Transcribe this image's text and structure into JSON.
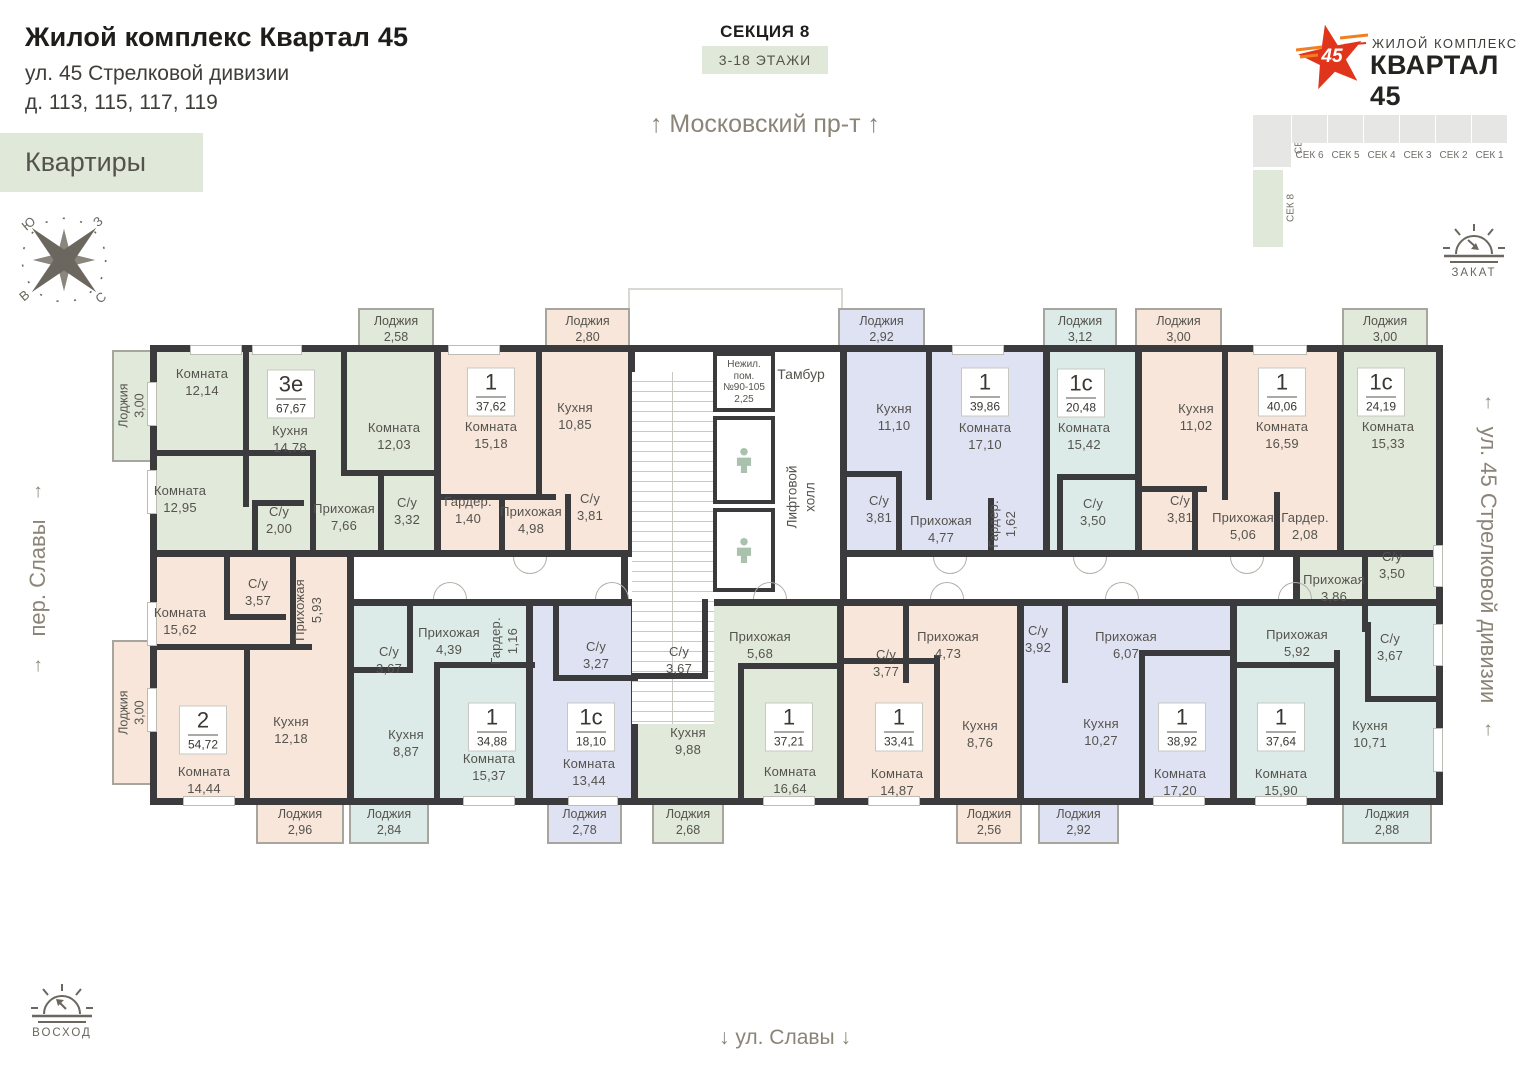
{
  "header": {
    "title": "Жилой комплекс Квартал 45",
    "address_line1": "ул. 45 Стрелковой дивизии",
    "address_line2": "д. 113, 115, 117, 119",
    "apartments_badge": "Квартиры"
  },
  "section": {
    "name": "СЕКЦИЯ 8",
    "floors": "3-18 ЭТАЖИ"
  },
  "streets": {
    "top": "Московский пр-т",
    "bottom": "ул. Славы",
    "left": "пер. Славы",
    "right": "ул. 45 Стрелковой дивизии",
    "arrow_up": "↑",
    "arrow_down": "↓"
  },
  "logo": {
    "number": "45",
    "line1": "ЖИЛОЙ КОМПЛЕКС",
    "line2": "КВАРТАЛ 45"
  },
  "minimap": {
    "top_sections": [
      "СЕК 6",
      "СЕК 5",
      "СЕК 4",
      "СЕК 3",
      "СЕК 2",
      "СЕК 1"
    ],
    "corner_section": "СЕК 7",
    "current_section": "СЕК 8"
  },
  "sun": {
    "sunset": "ЗАКАТ",
    "sunrise": "ВОСХОД"
  },
  "compass": {
    "nw": "Ю",
    "ne": "З",
    "sw": "В",
    "se": "С"
  },
  "core": {
    "nonres": [
      "Нежил.",
      "пом.",
      "№90-105",
      "2,25"
    ],
    "tambour": "Тамбур",
    "lift_hall_1": "Лифтовой",
    "lift_hall_2": "холл"
  },
  "colors": {
    "wall": "#3b3b3d",
    "green": "#e1e9da",
    "beige": "#f7e6d9",
    "lavender": "#dfe2f3",
    "cyan": "#dcebe7",
    "badge_bg": "#dfe8d9",
    "accent_red": "#e0351b",
    "accent_orange": "#f07f1f"
  },
  "plan": {
    "apartments": [
      {
        "id": "3e",
        "type": "3е",
        "area": "67,67",
        "color": "green",
        "rect": [
          150,
          345,
          291,
          212
        ],
        "badge": [
          291,
          394
        ],
        "rooms": [
          {
            "n": "Комната",
            "a": "12,14",
            "x": 202,
            "y": 383
          },
          {
            "n": "Кухня",
            "a": "14,78",
            "x": 290,
            "y": 440
          },
          {
            "n": "Комната",
            "a": "12,03",
            "x": 394,
            "y": 437
          },
          {
            "n": "Комната",
            "a": "12,95",
            "x": 180,
            "y": 500
          },
          {
            "n": "С/у",
            "a": "2,00",
            "x": 279,
            "y": 521
          },
          {
            "n": "Прихожая",
            "a": "7,66",
            "x": 344,
            "y": 518
          },
          {
            "n": "С/у",
            "a": "3,32",
            "x": 407,
            "y": 512
          }
        ]
      },
      {
        "id": "37-62",
        "type": "1",
        "area": "37,62",
        "color": "beige",
        "rect": [
          434,
          345,
          201,
          212
        ],
        "badge": [
          491,
          392
        ],
        "rooms": [
          {
            "n": "Комната",
            "a": "15,18",
            "x": 491,
            "y": 436
          },
          {
            "n": "Кухня",
            "a": "10,85",
            "x": 575,
            "y": 417
          },
          {
            "n": "Гардер.",
            "a": "1,40",
            "x": 468,
            "y": 511
          },
          {
            "n": "Прихожая",
            "a": "4,98",
            "x": 531,
            "y": 521
          },
          {
            "n": "С/у",
            "a": "3,81",
            "x": 590,
            "y": 508
          }
        ]
      },
      {
        "id": "39-86",
        "type": "1",
        "area": "39,86",
        "color": "lavender",
        "rect": [
          840,
          345,
          210,
          212
        ],
        "badge": [
          985,
          392
        ],
        "rooms": [
          {
            "n": "Кухня",
            "a": "11,10",
            "x": 894,
            "y": 418
          },
          {
            "n": "Комната",
            "a": "17,10",
            "x": 985,
            "y": 437
          },
          {
            "n": "С/у",
            "a": "3,81",
            "x": 879,
            "y": 510
          },
          {
            "n": "Прихожая",
            "a": "4,77",
            "x": 941,
            "y": 530
          },
          {
            "n": "Гардер.",
            "a": "1,62",
            "x": 1003,
            "y": 524,
            "v": 1
          }
        ]
      },
      {
        "id": "20-48",
        "type": "1с",
        "area": "20,48",
        "color": "cyan",
        "rect": [
          1043,
          345,
          99,
          212
        ],
        "badge": [
          1081,
          393
        ],
        "rooms": [
          {
            "n": "Комната",
            "a": "15,42",
            "x": 1084,
            "y": 437
          },
          {
            "n": "С/у",
            "a": "3,50",
            "x": 1093,
            "y": 513
          }
        ]
      },
      {
        "id": "40-06",
        "type": "1",
        "area": "40,06",
        "color": "beige",
        "rect": [
          1135,
          345,
          209,
          212
        ],
        "badge": [
          1282,
          392
        ],
        "rooms": [
          {
            "n": "Кухня",
            "a": "11,02",
            "x": 1196,
            "y": 418
          },
          {
            "n": "Комната",
            "a": "16,59",
            "x": 1282,
            "y": 436
          },
          {
            "n": "С/у",
            "a": "3,81",
            "x": 1180,
            "y": 510
          },
          {
            "n": "Прихожая",
            "a": "5,06",
            "x": 1243,
            "y": 527
          },
          {
            "n": "Гардер.",
            "a": "2,08",
            "x": 1305,
            "y": 527
          }
        ]
      },
      {
        "id": "24-19",
        "type": "1с",
        "area": "24,19",
        "color": "green",
        "rect": [
          1337,
          345,
          106,
          212
        ],
        "rect2": [
          1293,
          550,
          150,
          85
        ],
        "badge": [
          1381,
          392
        ],
        "rooms": [
          {
            "n": "Комната",
            "a": "15,33",
            "x": 1388,
            "y": 436
          },
          {
            "n": "С/у",
            "a": "3,50",
            "x": 1392,
            "y": 566
          },
          {
            "n": "Прихожая",
            "a": "3,86",
            "x": 1334,
            "y": 589
          }
        ]
      },
      {
        "id": "54-72",
        "type": "2",
        "area": "54,72",
        "color": "beige",
        "rect": [
          150,
          550,
          204,
          255
        ],
        "badge": [
          203,
          730
        ],
        "rooms": [
          {
            "n": "Комната",
            "a": "15,62",
            "x": 180,
            "y": 622
          },
          {
            "n": "С/у",
            "a": "3,57",
            "x": 258,
            "y": 593
          },
          {
            "n": "Прихожая",
            "a": "5,93",
            "x": 309,
            "y": 610,
            "v": 1
          },
          {
            "n": "Кухня",
            "a": "12,18",
            "x": 291,
            "y": 731
          },
          {
            "n": "Комната",
            "a": "14,44",
            "x": 204,
            "y": 781
          }
        ]
      },
      {
        "id": "34-88",
        "type": "1",
        "area": "34,88",
        "color": "cyan",
        "rect": [
          347,
          599,
          186,
          206
        ],
        "badge": [
          492,
          727
        ],
        "rooms": [
          {
            "n": "С/у",
            "a": "3,67",
            "x": 389,
            "y": 661
          },
          {
            "n": "Прихожая",
            "a": "4,39",
            "x": 449,
            "y": 642
          },
          {
            "n": "Гардер.",
            "a": "1,16",
            "x": 505,
            "y": 641,
            "v": 1
          },
          {
            "n": "Кухня",
            "a": "8,87",
            "x": 406,
            "y": 744
          },
          {
            "n": "Комната",
            "a": "15,37",
            "x": 489,
            "y": 768
          }
        ]
      },
      {
        "id": "18-10",
        "type": "1с",
        "area": "18,10",
        "color": "lavender",
        "rect": [
          526,
          599,
          112,
          206
        ],
        "badge": [
          591,
          727
        ],
        "rooms": [
          {
            "n": "С/у",
            "a": "3,27",
            "x": 596,
            "y": 656
          },
          {
            "n": "Комната",
            "a": "13,44",
            "x": 589,
            "y": 773
          }
        ]
      },
      {
        "id": "37-21",
        "type": "1",
        "area": "37,21",
        "color": "green",
        "rect": [
          631,
          599,
          213,
          206
        ],
        "badge": [
          789,
          727
        ],
        "rooms": [
          {
            "n": "Прихожая",
            "a": "5,68",
            "x": 760,
            "y": 646
          },
          {
            "n": "С/у",
            "a": "3,67",
            "x": 679,
            "y": 661
          },
          {
            "n": "Кухня",
            "a": "9,88",
            "x": 688,
            "y": 742
          },
          {
            "n": "Комната",
            "a": "16,64",
            "x": 790,
            "y": 781
          }
        ]
      },
      {
        "id": "33-41",
        "type": "1",
        "area": "33,41",
        "color": "beige",
        "rect": [
          837,
          599,
          187,
          206
        ],
        "badge": [
          899,
          727
        ],
        "rooms": [
          {
            "n": "С/у",
            "a": "3,77",
            "x": 886,
            "y": 664
          },
          {
            "n": "Прихожая",
            "a": "4,73",
            "x": 948,
            "y": 646
          },
          {
            "n": "Комната",
            "a": "14,87",
            "x": 897,
            "y": 783
          },
          {
            "n": "Кухня",
            "a": "8,76",
            "x": 980,
            "y": 735
          }
        ]
      },
      {
        "id": "38-92",
        "type": "1",
        "area": "38,92",
        "color": "lavender",
        "rect": [
          1017,
          599,
          220,
          206
        ],
        "badge": [
          1182,
          727
        ],
        "rooms": [
          {
            "n": "С/у",
            "a": "3,92",
            "x": 1038,
            "y": 640
          },
          {
            "n": "Прихожая",
            "a": "6,07",
            "x": 1126,
            "y": 646
          },
          {
            "n": "Кухня",
            "a": "10,27",
            "x": 1101,
            "y": 733
          },
          {
            "n": "Комната",
            "a": "17,20",
            "x": 1180,
            "y": 783
          }
        ]
      },
      {
        "id": "37-64",
        "type": "1",
        "area": "37,64",
        "color": "cyan",
        "rect": [
          1230,
          599,
          213,
          206
        ],
        "badge": [
          1281,
          727
        ],
        "rooms": [
          {
            "n": "Прихожая",
            "a": "5,92",
            "x": 1297,
            "y": 644
          },
          {
            "n": "С/у",
            "a": "3,67",
            "x": 1390,
            "y": 648
          },
          {
            "n": "Комната",
            "a": "15,90",
            "x": 1281,
            "y": 783
          },
          {
            "n": "Кухня",
            "a": "10,71",
            "x": 1370,
            "y": 735
          }
        ]
      }
    ],
    "balconies": [
      {
        "n": "Лоджия",
        "a": "3,00",
        "color": "green",
        "rect": [
          112,
          350,
          40,
          112
        ],
        "v": 1
      },
      {
        "n": "Лоджия",
        "a": "2,58",
        "color": "green",
        "rect": [
          358,
          308,
          76,
          44
        ]
      },
      {
        "n": "Лоджия",
        "a": "2,80",
        "color": "beige",
        "rect": [
          545,
          308,
          85,
          44
        ]
      },
      {
        "n": "Лоджия",
        "a": "2,92",
        "color": "lavender",
        "rect": [
          838,
          308,
          87,
          44
        ]
      },
      {
        "n": "Лоджия",
        "a": "3,12",
        "color": "cyan",
        "rect": [
          1043,
          308,
          74,
          44
        ]
      },
      {
        "n": "Лоджия",
        "a": "3,00",
        "color": "beige",
        "rect": [
          1135,
          308,
          87,
          44
        ]
      },
      {
        "n": "Лоджия",
        "a": "3,00",
        "color": "green",
        "rect": [
          1342,
          308,
          86,
          44
        ]
      },
      {
        "n": "Лоджия",
        "a": "3,00",
        "color": "beige",
        "rect": [
          112,
          640,
          40,
          145
        ],
        "v": 1
      },
      {
        "n": "Лоджия",
        "a": "2,96",
        "color": "beige",
        "rect": [
          256,
          802,
          88,
          42
        ]
      },
      {
        "n": "Лоджия",
        "a": "2,84",
        "color": "cyan",
        "rect": [
          349,
          802,
          80,
          42
        ]
      },
      {
        "n": "Лоджия",
        "a": "2,78",
        "color": "lavender",
        "rect": [
          547,
          802,
          75,
          42
        ]
      },
      {
        "n": "Лоджия",
        "a": "2,68",
        "color": "green",
        "rect": [
          652,
          802,
          72,
          42
        ]
      },
      {
        "n": "Лоджия",
        "a": "2,56",
        "color": "beige",
        "rect": [
          956,
          802,
          66,
          42
        ]
      },
      {
        "n": "Лоджия",
        "a": "2,92",
        "color": "lavender",
        "rect": [
          1038,
          802,
          81,
          42
        ]
      },
      {
        "n": "Лоджия",
        "a": "2,88",
        "color": "cyan",
        "rect": [
          1342,
          802,
          90,
          42
        ]
      }
    ],
    "walls": [
      [
        243,
        345,
        6,
        162
      ],
      [
        150,
        450,
        160,
        6
      ],
      [
        310,
        450,
        6,
        107
      ],
      [
        341,
        345,
        6,
        125
      ],
      [
        341,
        470,
        97,
        6
      ],
      [
        252,
        500,
        6,
        57
      ],
      [
        252,
        500,
        52,
        6
      ],
      [
        378,
        476,
        6,
        81
      ],
      [
        536,
        345,
        6,
        155
      ],
      [
        434,
        494,
        122,
        6
      ],
      [
        499,
        500,
        6,
        57
      ],
      [
        565,
        494,
        6,
        63
      ],
      [
        926,
        345,
        6,
        155
      ],
      [
        840,
        471,
        62,
        6
      ],
      [
        896,
        471,
        6,
        86
      ],
      [
        988,
        498,
        6,
        59
      ],
      [
        1057,
        474,
        80,
        6
      ],
      [
        1057,
        474,
        6,
        83
      ],
      [
        1222,
        345,
        6,
        155
      ],
      [
        1135,
        486,
        72,
        6
      ],
      [
        1192,
        486,
        6,
        71
      ],
      [
        1274,
        492,
        6,
        65
      ],
      [
        1362,
        553,
        6,
        79
      ],
      [
        150,
        644,
        162,
        6
      ],
      [
        290,
        557,
        6,
        93
      ],
      [
        244,
        644,
        6,
        161
      ],
      [
        224,
        557,
        6,
        63
      ],
      [
        224,
        614,
        62,
        6
      ],
      [
        407,
        599,
        6,
        74
      ],
      [
        347,
        667,
        66,
        6
      ],
      [
        434,
        662,
        6,
        143
      ],
      [
        434,
        662,
        101,
        6
      ],
      [
        553,
        599,
        6,
        82
      ],
      [
        553,
        675,
        85,
        6
      ],
      [
        702,
        599,
        6,
        80
      ],
      [
        631,
        673,
        77,
        6
      ],
      [
        738,
        663,
        6,
        142
      ],
      [
        738,
        663,
        101,
        6
      ],
      [
        903,
        599,
        6,
        84
      ],
      [
        837,
        658,
        100,
        6
      ],
      [
        934,
        655,
        6,
        150
      ],
      [
        1062,
        599,
        6,
        84
      ],
      [
        1139,
        650,
        6,
        155
      ],
      [
        1139,
        650,
        94,
        6
      ],
      [
        1334,
        650,
        6,
        155
      ],
      [
        1230,
        662,
        110,
        6
      ],
      [
        1365,
        622,
        6,
        80
      ],
      [
        1365,
        696,
        78,
        6
      ]
    ],
    "windows": [
      [
        190,
        345,
        52,
        10
      ],
      [
        252,
        345,
        50,
        10
      ],
      [
        448,
        345,
        52,
        10
      ],
      [
        952,
        345,
        52,
        10
      ],
      [
        1253,
        345,
        54,
        10
      ],
      [
        183,
        796,
        52,
        10
      ],
      [
        463,
        796,
        52,
        10
      ],
      [
        568,
        796,
        50,
        10
      ],
      [
        763,
        796,
        52,
        10
      ],
      [
        868,
        796,
        52,
        10
      ],
      [
        1153,
        796,
        52,
        10
      ],
      [
        1255,
        796,
        52,
        10
      ],
      [
        147,
        382,
        10,
        44
      ],
      [
        147,
        470,
        10,
        44
      ],
      [
        147,
        602,
        10,
        44
      ],
      [
        147,
        688,
        10,
        44
      ],
      [
        1433,
        545,
        10,
        42
      ],
      [
        1433,
        624,
        10,
        42
      ],
      [
        1433,
        728,
        10,
        44
      ]
    ],
    "arcs": [
      [
        530,
        557,
        "d"
      ],
      [
        950,
        557,
        "d"
      ],
      [
        1090,
        557,
        "d"
      ],
      [
        1247,
        557,
        "d"
      ],
      [
        450,
        599,
        "u"
      ],
      [
        612,
        599,
        "u"
      ],
      [
        770,
        599,
        "u"
      ],
      [
        947,
        599,
        "u"
      ],
      [
        1122,
        599,
        "u"
      ],
      [
        1295,
        599,
        "u"
      ]
    ]
  }
}
